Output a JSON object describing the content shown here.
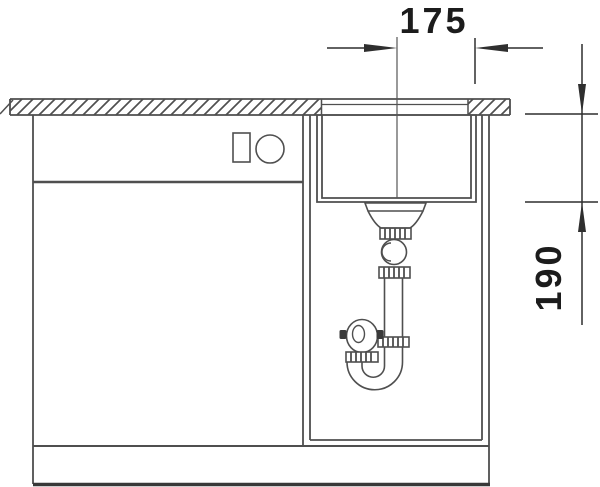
{
  "drawing": {
    "dimension_width_mm": "175",
    "dimension_depth_mm": "190",
    "colors": {
      "background": "#ffffff",
      "line": "#4f4f4f",
      "dimension": "#2f2f2f",
      "text": "#1c1c1c"
    }
  }
}
